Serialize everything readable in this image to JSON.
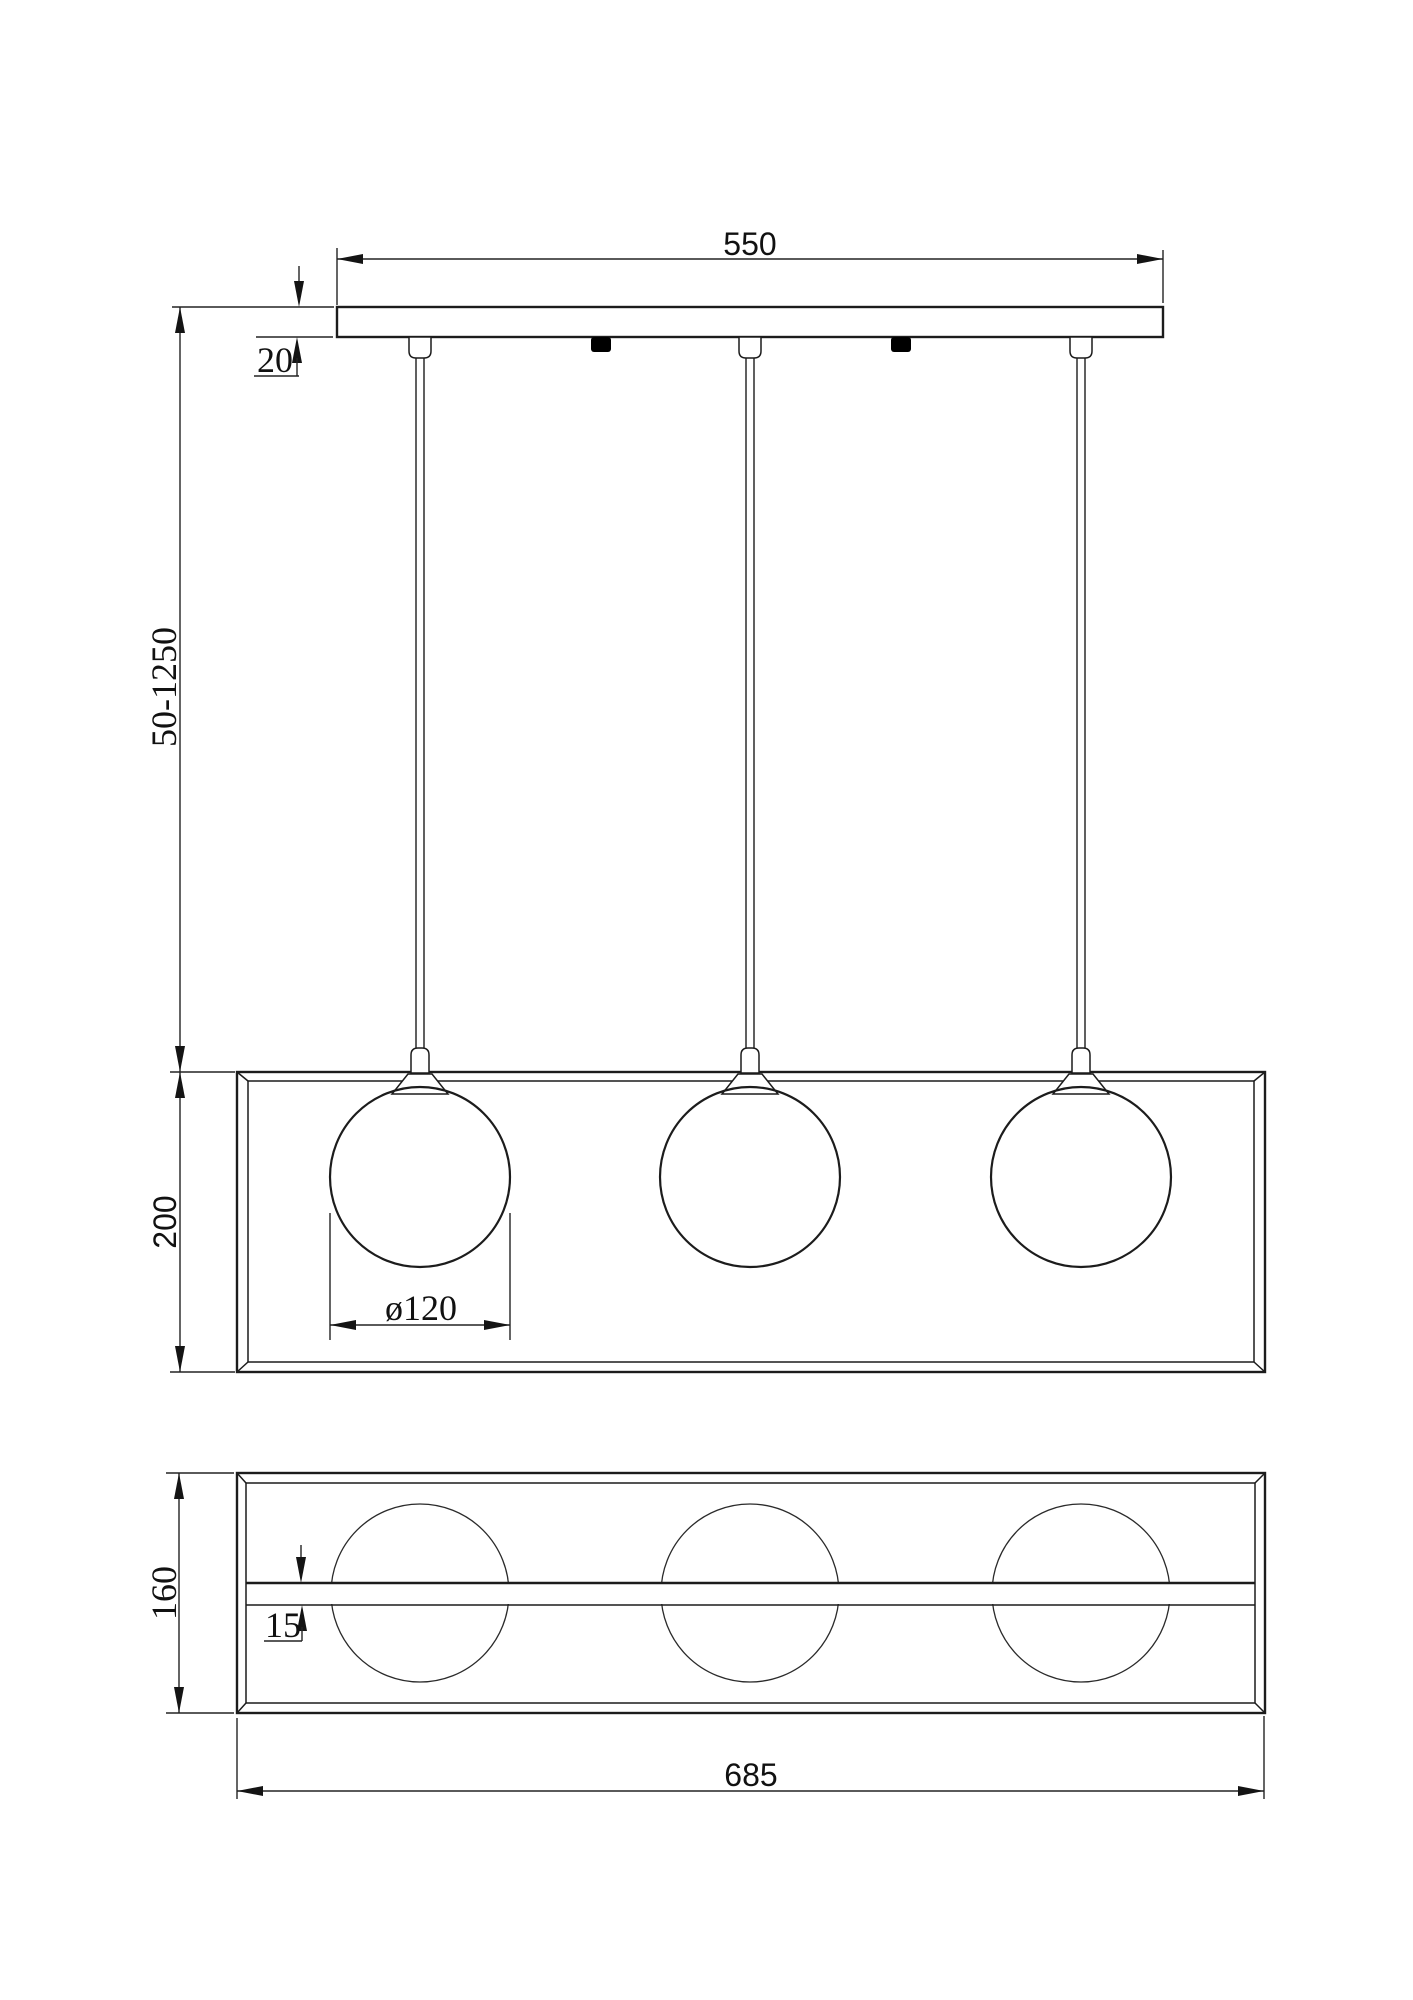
{
  "drawing": {
    "type": "pendant-lamp-dimension-drawing",
    "colors": {
      "line": "#1c1c1c",
      "dimension_line": "#232323",
      "marker_fill": "#000000",
      "background": "#ffffff"
    },
    "front_view": {
      "plate_width": "550",
      "plate_thickness": "20",
      "suspension_height": "50-1250",
      "frame_height": "200",
      "globe_diameter": "ø120",
      "globe_count": 3
    },
    "bottom_view": {
      "frame_depth": "160",
      "bar_thickness": "15",
      "frame_width": "685"
    }
  }
}
